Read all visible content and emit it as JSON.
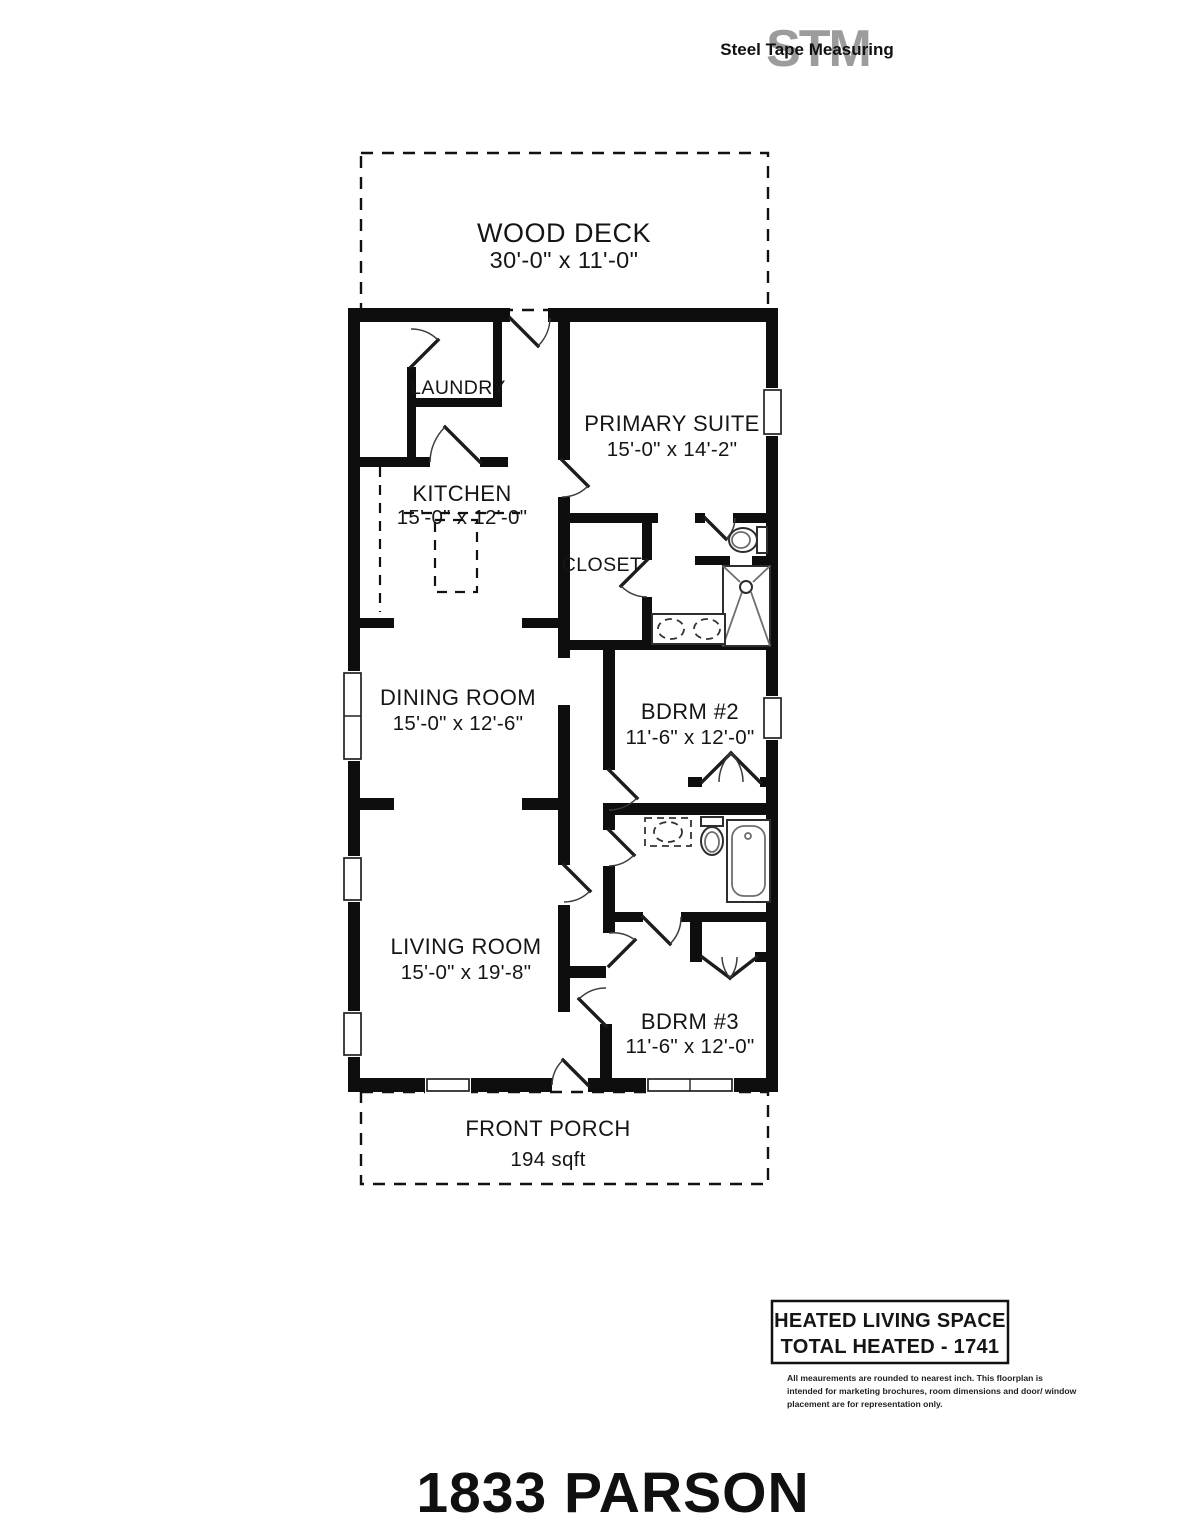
{
  "logo": {
    "monogram": "STM",
    "text": "Steel Tape Measuring"
  },
  "rooms": {
    "wood_deck": {
      "name": "WOOD DECK",
      "dims": "30'-0\" x 11'-0\""
    },
    "laundry": {
      "name": "LAUNDRY"
    },
    "primary_suite": {
      "name": "PRIMARY SUITE",
      "dims": "15'-0\" x 14'-2\""
    },
    "kitchen": {
      "name": "KITCHEN",
      "dims": "15'-0\" x 12'-0\""
    },
    "closet": {
      "name": "CLOSET"
    },
    "dining_room": {
      "name": "DINING ROOM",
      "dims": "15'-0\" x 12'-6\""
    },
    "bdrm2": {
      "name": "BDRM #2",
      "dims": "11'-6\" x 12'-0\""
    },
    "living_room": {
      "name": "LIVING ROOM",
      "dims": "15'-0\" x 19'-8\""
    },
    "bdrm3": {
      "name": "BDRM #3",
      "dims": "11'-6\" x 12'-0\""
    },
    "front_porch": {
      "name": "FRONT PORCH",
      "dims": "194 sqft"
    }
  },
  "summary": {
    "line1": "HEATED LIVING SPACE",
    "line2": "TOTAL HEATED - 1741"
  },
  "disclaimer": {
    "line1": "All meaurements are rounded to nearest inch. This floorplan is",
    "line2": "intended for marketing brochures, room dimensions and door/ window",
    "line3": "placement are for representation only."
  },
  "title": "1833 PARSON",
  "colors": {
    "wall": "#0e0e0e",
    "text": "#151515",
    "logo_gray": "#9c9c9c"
  }
}
